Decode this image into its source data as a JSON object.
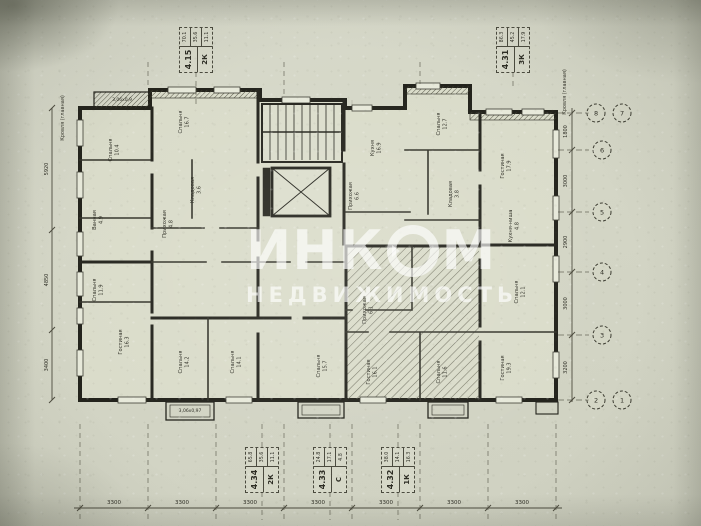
{
  "watermark": {
    "brand_pre": "ИНК",
    "brand_post": "М",
    "line2": "НЕДВИЖИМОСТЬ"
  },
  "edge_labels": {
    "top_left": "Кровля (главная)",
    "top_right": "Кровля (главная)"
  },
  "callouts": [
    {
      "num": "4.15",
      "type": "2К",
      "areas": [
        "70.1",
        "35.6",
        "11.1"
      ]
    },
    {
      "num": "4.31",
      "type": "3К",
      "areas": [
        "86.3",
        "45.2",
        "17.9"
      ]
    },
    {
      "num": "4.34",
      "type": "2К",
      "areas": [
        "65.8",
        "35.6",
        "11.1"
      ]
    },
    {
      "num": "4.33",
      "type": "С",
      "areas": [
        "24.8",
        "17.1",
        "4.8"
      ]
    },
    {
      "num": "4.32",
      "type": "1К",
      "areas": [
        "38.0",
        "14.1",
        "16.3"
      ]
    }
  ],
  "rooms": [
    {
      "label": "Спальня",
      "area": "10.4"
    },
    {
      "label": "Спальня",
      "area": "16.7"
    },
    {
      "label": "Кладовая",
      "area": "3.6"
    },
    {
      "label": "Прихожая",
      "area": "4.8"
    },
    {
      "label": "Ванная",
      "area": "4.9"
    },
    {
      "label": "Спальня",
      "area": "11.9"
    },
    {
      "label": "Гостиная",
      "area": "16.3"
    },
    {
      "label": "Спальня",
      "area": "14.2"
    },
    {
      "label": "Спальня",
      "area": "14.1"
    },
    {
      "label": "Спальня",
      "area": "15.7"
    },
    {
      "label": "Кухня",
      "area": "16.9"
    },
    {
      "label": "Прихожая",
      "area": "6.6"
    },
    {
      "label": "Спальня",
      "area": "12.7"
    },
    {
      "label": "Гостиная",
      "area": "17.9"
    },
    {
      "label": "Кладовая",
      "area": "3.8"
    },
    {
      "label": "Кухня-ниша",
      "area": "4.8"
    },
    {
      "label": "Спальня",
      "area": "12.1"
    },
    {
      "label": "Прихожая",
      "area": "6.1"
    },
    {
      "label": "Гостиная",
      "area": "16.1"
    },
    {
      "label": "Спальня",
      "area": "11.6"
    },
    {
      "label": "Гостиная",
      "area": "19.3"
    }
  ],
  "balconies": {
    "top_left": "3,06х0,9",
    "bottom_center": "3,06х0,97"
  },
  "dims": {
    "bottom": [
      "3300",
      "3300",
      "3300",
      "3300",
      "3300",
      "3300",
      "3300"
    ],
    "right": [
      "1800",
      "3000",
      "2900",
      "3000",
      "3200"
    ],
    "left": [
      "5920",
      "4850",
      "3400"
    ]
  },
  "axes": {
    "right": [
      "8",
      "7",
      "6",
      "5",
      "4",
      "3",
      "2",
      "1"
    ]
  }
}
